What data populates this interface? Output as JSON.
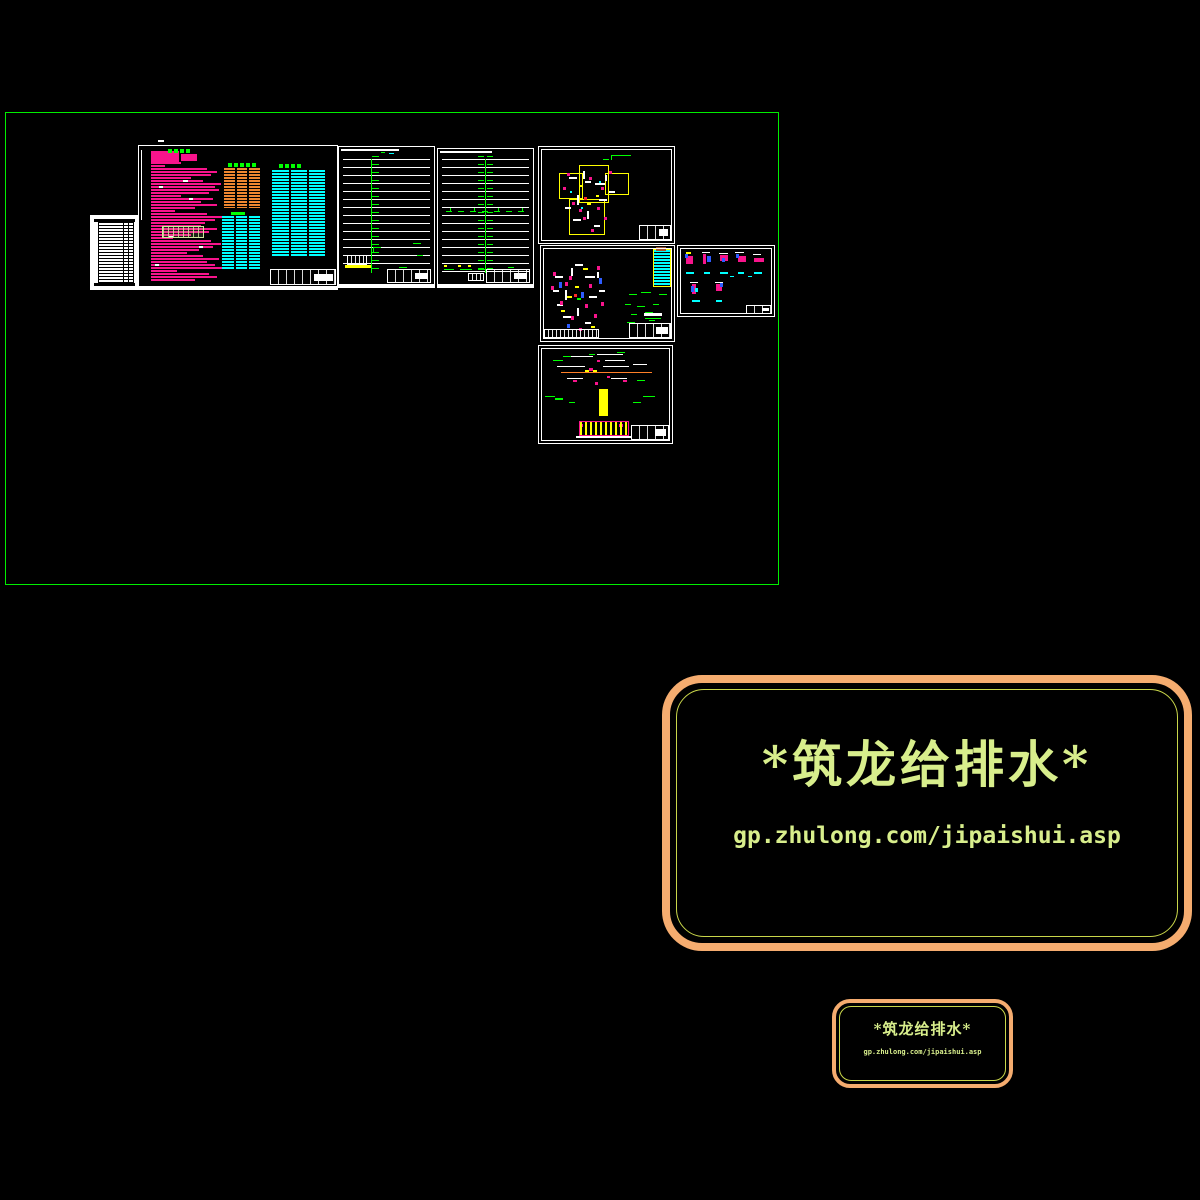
{
  "watermark_large": {
    "brand": "*筑龙给排水*",
    "url": "gp.zhulong.com/jipaishui.asp"
  },
  "watermark_small": {
    "brand": "*筑龙给排水*",
    "url": "gp.zhulong.com/jipaishui.asp"
  },
  "colors": {
    "background": "#000000",
    "model_boundary": "#00ee00",
    "sheet_frame": "#ffffff",
    "notes_text": "#f8148c",
    "table_orange": "#ef8630",
    "table_cyan": "#00ffff",
    "annotation_green": "#00ff00",
    "highlight_yellow": "#ffff00",
    "watermark_border": "#f5ac6f",
    "watermark_line": "#c9d64a",
    "watermark_text": "#d8ee8c"
  },
  "palette": {
    "m": "#f8148c",
    "b": "#2e5cff",
    "c": "#00ffff",
    "y": "#ffff00",
    "w": "#ffffff",
    "g": "#00ff00",
    "r": "#ff2a2a",
    "o": "#ff7f27",
    "bn": "#a0522d"
  },
  "decor": {
    "note_bars": {
      "x": 12,
      "y": 16,
      "step": 3,
      "h": 2,
      "color": "#f8148c",
      "widths": [
        30,
        14,
        56,
        66,
        60,
        40,
        52,
        70,
        64,
        68,
        58,
        30,
        62,
        50,
        66,
        44,
        24,
        56,
        72,
        64,
        54,
        50,
        66,
        58,
        40,
        22,
        60,
        70,
        62,
        48,
        36,
        52,
        68,
        56,
        64,
        78,
        26,
        58,
        66,
        44
      ]
    },
    "b_dots": [
      [
        12,
        5,
        28,
        12,
        "m"
      ],
      [
        42,
        8,
        16,
        7,
        "m"
      ],
      [
        29,
        3,
        4,
        4,
        "g"
      ],
      [
        35,
        3,
        4,
        4,
        "g"
      ],
      [
        41,
        3,
        4,
        4,
        "g"
      ],
      [
        47,
        3,
        4,
        4,
        "g"
      ],
      [
        92,
        66,
        14,
        3,
        "g"
      ],
      [
        20,
        40,
        4,
        2,
        "w"
      ],
      [
        50,
        52,
        4,
        2,
        "w"
      ],
      [
        30,
        90,
        4,
        2,
        "w"
      ],
      [
        60,
        100,
        4,
        2,
        "w"
      ],
      [
        16,
        118,
        4,
        2,
        "w"
      ],
      [
        44,
        34,
        5,
        2,
        "w"
      ],
      [
        96,
        84,
        3,
        2,
        "m"
      ],
      [
        96,
        96,
        3,
        2,
        "m"
      ],
      [
        93,
        102,
        2,
        6,
        "y"
      ],
      [
        97,
        108,
        3,
        3,
        "m"
      ]
    ],
    "riser1_dots": [
      [
        50,
        6,
        5,
        1,
        "c"
      ],
      [
        42,
        5,
        4,
        1,
        "g"
      ],
      [
        34,
        100,
        8,
        1,
        "g"
      ],
      [
        34,
        100,
        1,
        6,
        "g"
      ],
      [
        74,
        96,
        8,
        1,
        "g"
      ],
      [
        78,
        108,
        6,
        1,
        "g"
      ],
      [
        60,
        120,
        8,
        1,
        "g"
      ]
    ],
    "riser2_dots": [
      [
        8,
        62,
        6,
        1,
        "g"
      ],
      [
        20,
        62,
        6,
        1,
        "g"
      ],
      [
        32,
        62,
        6,
        1,
        "g"
      ],
      [
        44,
        62,
        6,
        1,
        "g"
      ],
      [
        56,
        62,
        6,
        1,
        "g"
      ],
      [
        68,
        62,
        6,
        1,
        "g"
      ],
      [
        80,
        62,
        6,
        1,
        "g"
      ],
      [
        12,
        59,
        1,
        3,
        "g"
      ],
      [
        36,
        59,
        1,
        3,
        "g"
      ],
      [
        60,
        59,
        1,
        3,
        "g"
      ],
      [
        84,
        59,
        1,
        3,
        "g"
      ],
      [
        6,
        116,
        3,
        2,
        "y"
      ],
      [
        20,
        116,
        3,
        2,
        "y"
      ],
      [
        30,
        116,
        3,
        2,
        "y"
      ],
      [
        6,
        120,
        10,
        1,
        "g"
      ],
      [
        22,
        120,
        12,
        1,
        "g"
      ],
      [
        40,
        120,
        10,
        1,
        "g"
      ],
      [
        56,
        120,
        8,
        1,
        "g"
      ],
      [
        70,
        118,
        6,
        1,
        "g"
      ]
    ],
    "plan1_dots": [
      [
        30,
        30,
        8,
        2,
        "w"
      ],
      [
        44,
        24,
        2,
        8,
        "w"
      ],
      [
        56,
        36,
        10,
        2,
        "w"
      ],
      [
        38,
        48,
        2,
        10,
        "w"
      ],
      [
        60,
        52,
        8,
        2,
        "w"
      ],
      [
        26,
        60,
        6,
        2,
        "w"
      ],
      [
        48,
        64,
        2,
        8,
        "w"
      ],
      [
        66,
        28,
        2,
        6,
        "w"
      ],
      [
        70,
        44,
        6,
        2,
        "w"
      ],
      [
        34,
        72,
        8,
        2,
        "w"
      ],
      [
        55,
        78,
        6,
        2,
        "w"
      ],
      [
        46,
        34,
        6,
        2,
        "w"
      ],
      [
        28,
        26,
        3,
        3,
        "m"
      ],
      [
        50,
        30,
        3,
        3,
        "m"
      ],
      [
        62,
        40,
        3,
        3,
        "m"
      ],
      [
        33,
        55,
        3,
        3,
        "m"
      ],
      [
        58,
        60,
        3,
        3,
        "m"
      ],
      [
        44,
        70,
        3,
        3,
        "m"
      ],
      [
        65,
        70,
        3,
        3,
        "m"
      ],
      [
        24,
        40,
        3,
        3,
        "m"
      ],
      [
        70,
        24,
        3,
        3,
        "m"
      ],
      [
        52,
        82,
        3,
        3,
        "m"
      ],
      [
        40,
        62,
        3,
        3,
        "m"
      ],
      [
        31,
        44,
        2,
        2,
        "c"
      ],
      [
        60,
        34,
        2,
        2,
        "c"
      ],
      [
        42,
        60,
        2,
        2,
        "c"
      ],
      [
        45,
        50,
        3,
        3,
        "r"
      ],
      [
        40,
        38,
        3,
        2,
        "y"
      ],
      [
        57,
        48,
        3,
        2,
        "y"
      ],
      [
        48,
        56,
        4,
        2,
        "y"
      ],
      [
        72,
        8,
        20,
        1,
        "g"
      ],
      [
        72,
        8,
        1,
        5,
        "g"
      ],
      [
        64,
        12,
        6,
        1,
        "g"
      ]
    ],
    "plan2_dots": [
      [
        14,
        30,
        8,
        2,
        "w"
      ],
      [
        30,
        22,
        2,
        8,
        "w"
      ],
      [
        44,
        30,
        10,
        2,
        "w"
      ],
      [
        24,
        44,
        2,
        10,
        "w"
      ],
      [
        48,
        50,
        8,
        2,
        "w"
      ],
      [
        16,
        58,
        6,
        2,
        "w"
      ],
      [
        36,
        62,
        2,
        8,
        "w"
      ],
      [
        56,
        26,
        2,
        6,
        "w"
      ],
      [
        58,
        44,
        6,
        2,
        "w"
      ],
      [
        22,
        70,
        8,
        2,
        "w"
      ],
      [
        44,
        76,
        6,
        2,
        "w"
      ],
      [
        12,
        44,
        6,
        2,
        "w"
      ],
      [
        34,
        18,
        8,
        2,
        "w"
      ],
      [
        12,
        26,
        3,
        4,
        "m"
      ],
      [
        28,
        30,
        3,
        4,
        "m"
      ],
      [
        48,
        38,
        3,
        4,
        "m"
      ],
      [
        19,
        55,
        3,
        4,
        "m"
      ],
      [
        44,
        58,
        3,
        4,
        "m"
      ],
      [
        30,
        70,
        3,
        4,
        "m"
      ],
      [
        53,
        68,
        3,
        4,
        "m"
      ],
      [
        10,
        40,
        3,
        4,
        "m"
      ],
      [
        56,
        20,
        3,
        4,
        "m"
      ],
      [
        38,
        82,
        3,
        3,
        "m"
      ],
      [
        60,
        56,
        3,
        4,
        "m"
      ],
      [
        24,
        36,
        3,
        4,
        "m"
      ],
      [
        18,
        36,
        3,
        6,
        "b"
      ],
      [
        40,
        46,
        3,
        6,
        "b"
      ],
      [
        58,
        32,
        3,
        6,
        "b"
      ],
      [
        26,
        78,
        3,
        4,
        "b"
      ],
      [
        26,
        50,
        5,
        2,
        "y"
      ],
      [
        42,
        22,
        5,
        2,
        "y"
      ],
      [
        34,
        40,
        4,
        2,
        "y"
      ],
      [
        50,
        80,
        4,
        2,
        "y"
      ],
      [
        20,
        64,
        4,
        2,
        "y"
      ],
      [
        36,
        52,
        4,
        2,
        "g"
      ],
      [
        33,
        48,
        3,
        3,
        "r"
      ],
      [
        88,
        48,
        8,
        1,
        "g"
      ],
      [
        100,
        46,
        10,
        1,
        "g"
      ],
      [
        118,
        48,
        8,
        1,
        "g"
      ],
      [
        84,
        58,
        6,
        1,
        "g"
      ],
      [
        96,
        60,
        8,
        1,
        "g"
      ],
      [
        112,
        58,
        6,
        1,
        "g"
      ],
      [
        90,
        68,
        6,
        1,
        "g"
      ],
      [
        104,
        66,
        8,
        1,
        "g"
      ],
      [
        86,
        76,
        8,
        1,
        "g"
      ],
      [
        108,
        74,
        6,
        1,
        "g"
      ],
      [
        103,
        67,
        18,
        3,
        "w"
      ],
      [
        104,
        72,
        16,
        1,
        "g"
      ]
    ],
    "details_dots": [
      [
        8,
        10,
        7,
        8,
        "m"
      ],
      [
        7,
        8,
        3,
        4,
        "b"
      ],
      [
        8,
        6,
        5,
        2,
        "y"
      ],
      [
        25,
        8,
        3,
        10,
        "m"
      ],
      [
        29,
        10,
        4,
        6,
        "b"
      ],
      [
        24,
        6,
        8,
        1,
        "w"
      ],
      [
        42,
        9,
        8,
        6,
        "m"
      ],
      [
        41,
        7,
        9,
        1,
        "w"
      ],
      [
        44,
        12,
        3,
        4,
        "b"
      ],
      [
        60,
        10,
        8,
        6,
        "m"
      ],
      [
        58,
        8,
        3,
        4,
        "b"
      ],
      [
        57,
        6,
        9,
        1,
        "w"
      ],
      [
        76,
        12,
        10,
        4,
        "m"
      ],
      [
        75,
        8,
        8,
        1,
        "w"
      ],
      [
        8,
        26,
        8,
        2,
        "c"
      ],
      [
        26,
        26,
        6,
        2,
        "c"
      ],
      [
        42,
        26,
        8,
        2,
        "c"
      ],
      [
        60,
        26,
        6,
        2,
        "c"
      ],
      [
        76,
        26,
        8,
        2,
        "c"
      ],
      [
        14,
        38,
        4,
        10,
        "m"
      ],
      [
        13,
        40,
        3,
        6,
        "b"
      ],
      [
        12,
        36,
        8,
        1,
        "w"
      ],
      [
        17,
        42,
        3,
        4,
        "c"
      ],
      [
        38,
        38,
        6,
        7,
        "m"
      ],
      [
        42,
        36,
        3,
        5,
        "b"
      ],
      [
        37,
        36,
        8,
        1,
        "w"
      ],
      [
        14,
        54,
        8,
        2,
        "c"
      ],
      [
        38,
        54,
        6,
        2,
        "c"
      ],
      [
        52,
        30,
        4,
        1,
        "c"
      ],
      [
        70,
        30,
        4,
        1,
        "c"
      ]
    ],
    "section_dots": [
      [
        30,
        10,
        24,
        1,
        "w"
      ],
      [
        58,
        8,
        26,
        1,
        "w"
      ],
      [
        66,
        14,
        20,
        1,
        "w"
      ],
      [
        18,
        20,
        28,
        1,
        "w"
      ],
      [
        64,
        20,
        26,
        1,
        "w"
      ],
      [
        94,
        18,
        14,
        1,
        "w"
      ],
      [
        28,
        32,
        16,
        1,
        "w"
      ],
      [
        72,
        32,
        16,
        1,
        "w"
      ],
      [
        96,
        26,
        12,
        1,
        "w"
      ],
      [
        50,
        22,
        4,
        3,
        "m"
      ],
      [
        56,
        36,
        3,
        3,
        "m"
      ],
      [
        68,
        30,
        3,
        2,
        "m"
      ],
      [
        34,
        34,
        4,
        2,
        "m"
      ],
      [
        84,
        34,
        4,
        2,
        "m"
      ],
      [
        58,
        14,
        3,
        2,
        "m"
      ],
      [
        40,
        78,
        4,
        3,
        "m"
      ],
      [
        80,
        78,
        4,
        3,
        "m"
      ],
      [
        6,
        50,
        10,
        1,
        "g"
      ],
      [
        14,
        14,
        10,
        1,
        "g"
      ],
      [
        24,
        10,
        8,
        1,
        "g"
      ],
      [
        50,
        8,
        6,
        1,
        "g"
      ],
      [
        78,
        6,
        8,
        1,
        "g"
      ],
      [
        98,
        34,
        8,
        1,
        "g"
      ],
      [
        104,
        50,
        12,
        1,
        "g"
      ],
      [
        16,
        52,
        8,
        2,
        "g"
      ],
      [
        30,
        56,
        6,
        1,
        "g"
      ],
      [
        94,
        56,
        8,
        1,
        "g"
      ],
      [
        46,
        24,
        4,
        2,
        "y"
      ],
      [
        54,
        24,
        4,
        2,
        "y"
      ]
    ]
  }
}
